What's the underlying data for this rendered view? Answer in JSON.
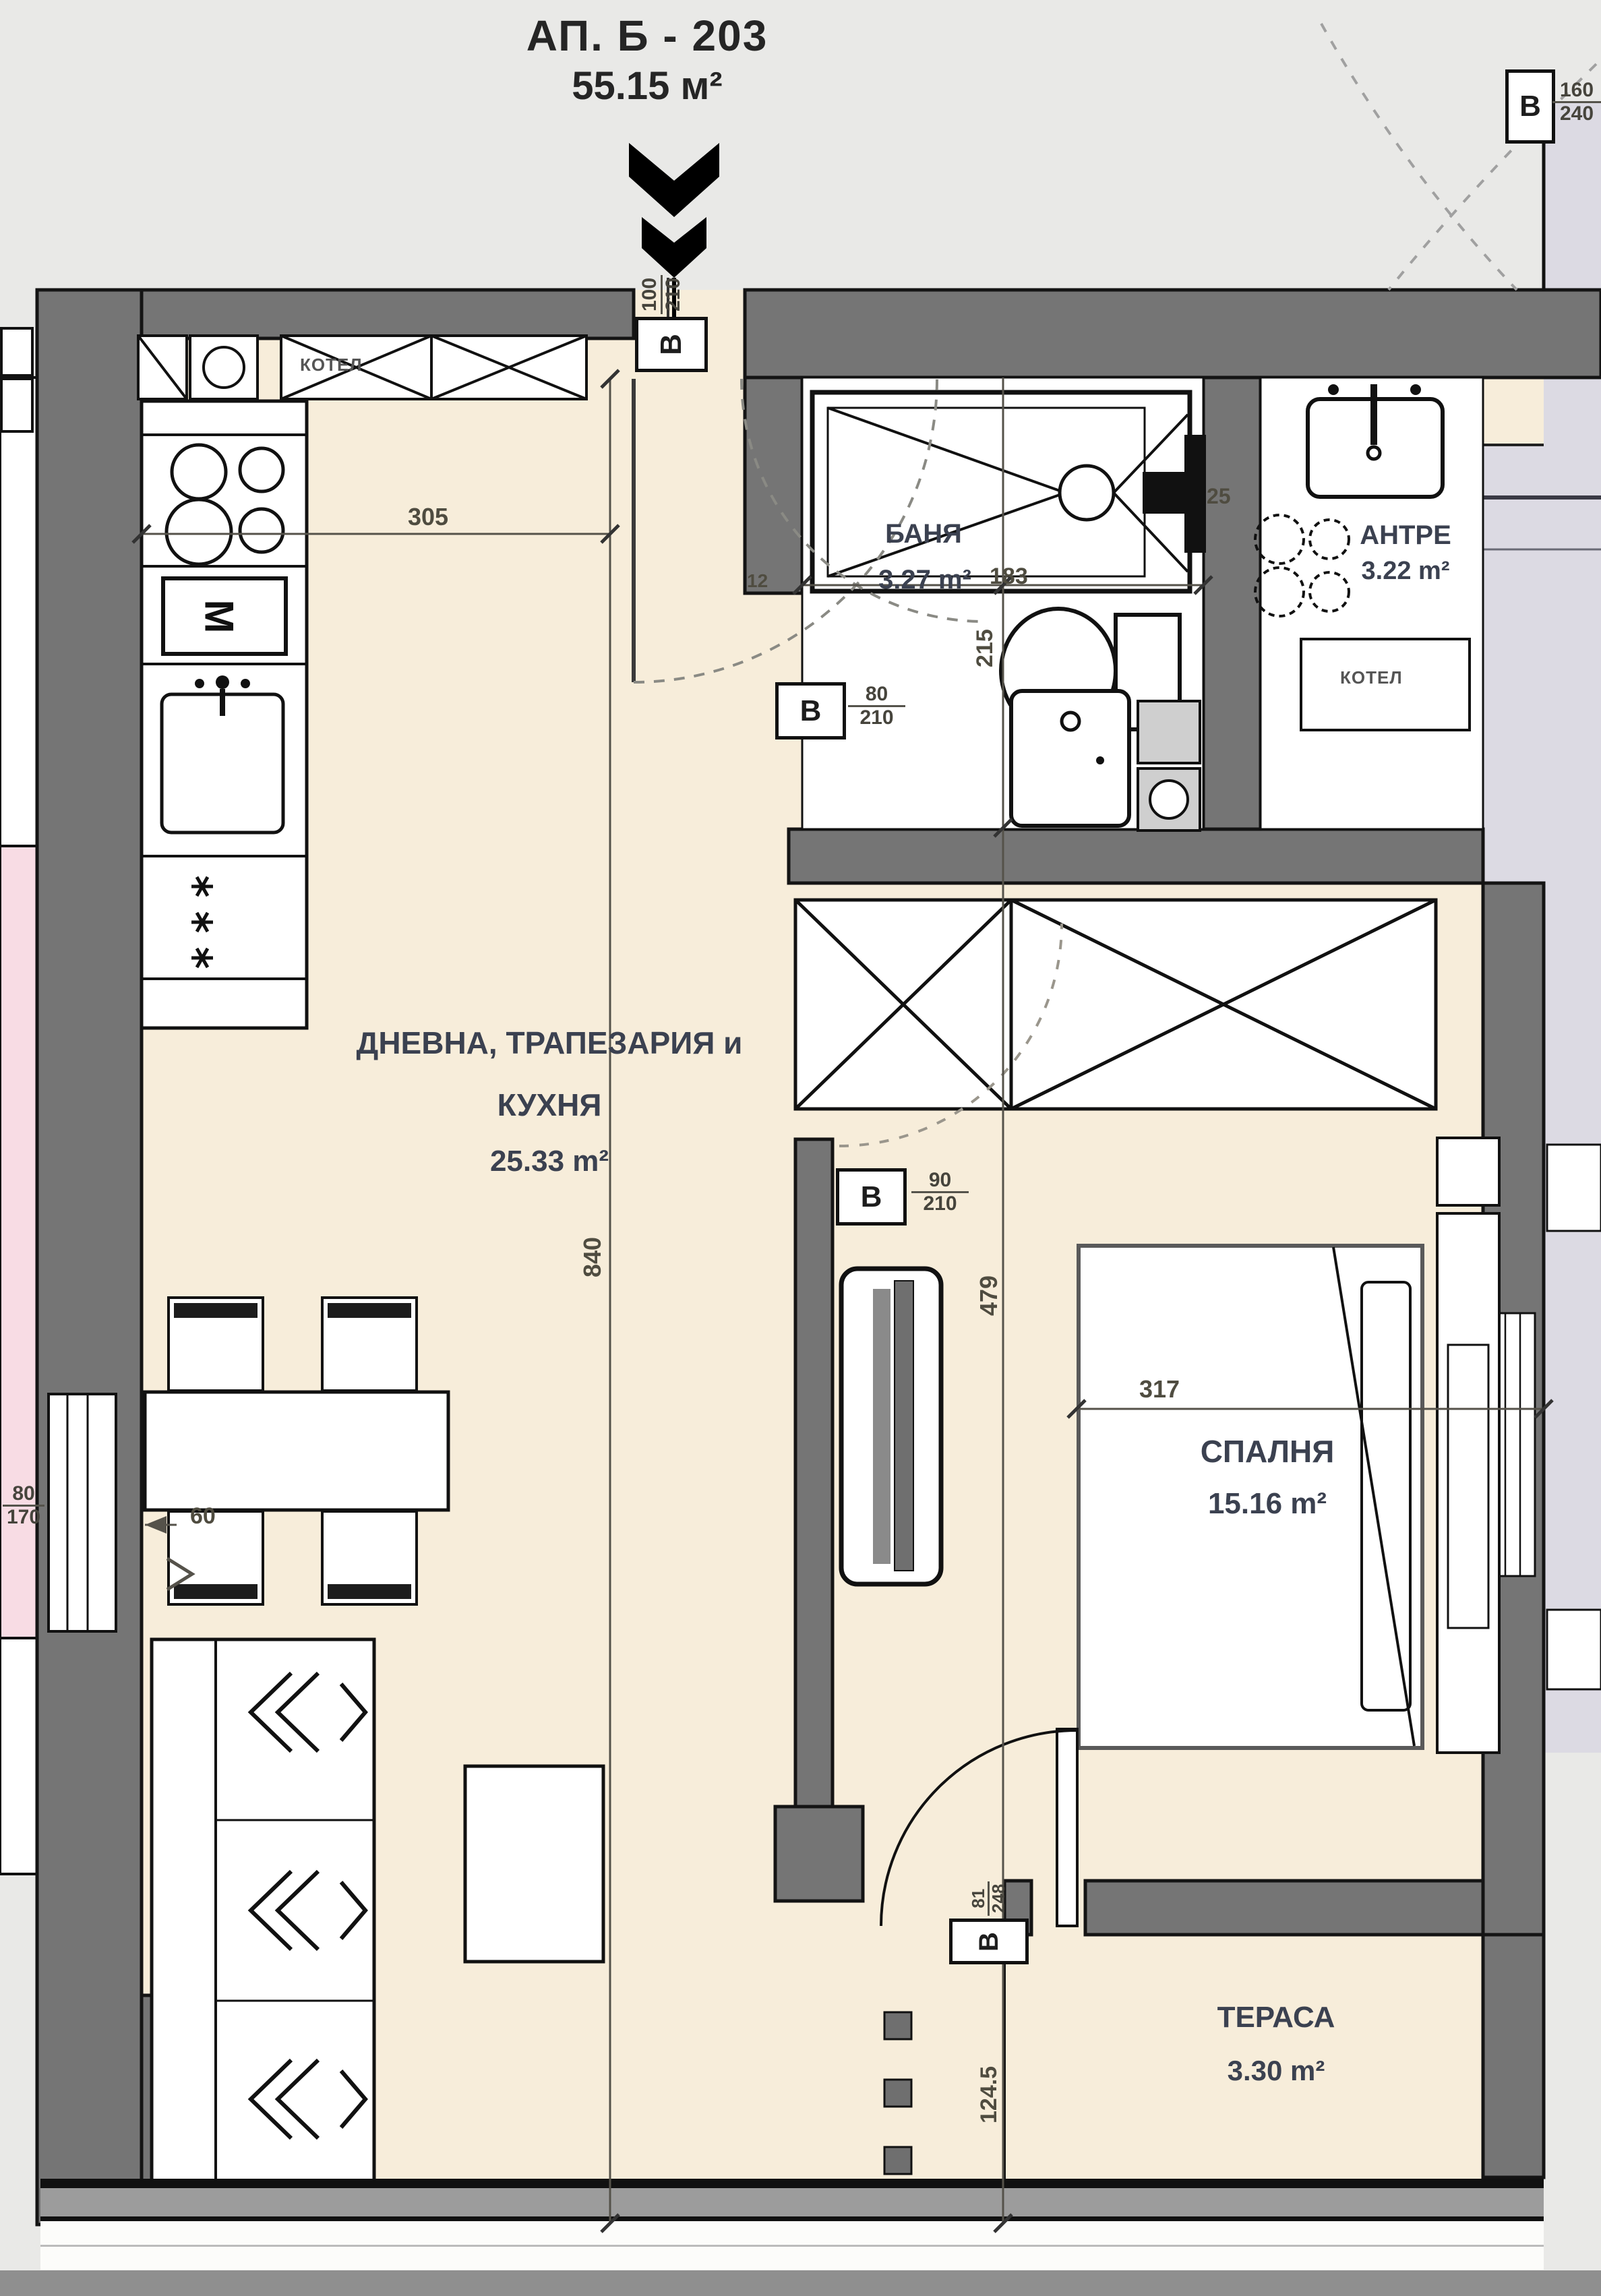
{
  "title": {
    "line1": "АП. Б - 203",
    "line2": "55.15 м²"
  },
  "rooms": {
    "living": {
      "line1": "ДНЕВНА, ТРАПЕЗАРИЯ и",
      "line2": "КУХНЯ",
      "area": "25.33 m²"
    },
    "bath": {
      "name": "БАНЯ",
      "area": "3.27 m²"
    },
    "antre": {
      "name": "АНТРЕ",
      "area": "3.22 m²"
    },
    "bedroom": {
      "name": "СПАЛНЯ",
      "area": "15.16 m²"
    },
    "terrace": {
      "name": "ТЕРАСА",
      "area": "3.30 m²"
    }
  },
  "equipment": {
    "boiler_top": "КОТЕЛ",
    "boiler_closet": "КОТЕЛ",
    "oven_letter": "М"
  },
  "dims": {
    "w305": "305",
    "h840": "840",
    "h215": "215",
    "w183": "183",
    "t25": "25",
    "t12": "12",
    "h479": "479",
    "w317": "317",
    "w60": "60",
    "h124": "124.5",
    "win": {
      "w": "80",
      "h": "170"
    }
  },
  "doors": {
    "entry": {
      "tag": "В",
      "num": "100",
      "den": "210"
    },
    "bath": {
      "tag": "В",
      "num": "80",
      "den": "210"
    },
    "bedroom": {
      "tag": "В",
      "num": "90",
      "den": "210"
    },
    "terrace": {
      "tag": "В",
      "num": "81",
      "den": "248"
    },
    "neighbor": {
      "tag": "В",
      "num": "160",
      "den": "240"
    }
  },
  "colors": {
    "wall": "#757575",
    "floor": "#f7edda",
    "pink": "#f8dce4",
    "lavender": "#dcdae3",
    "label": "#3b4150",
    "dim": "#4f4c40"
  }
}
